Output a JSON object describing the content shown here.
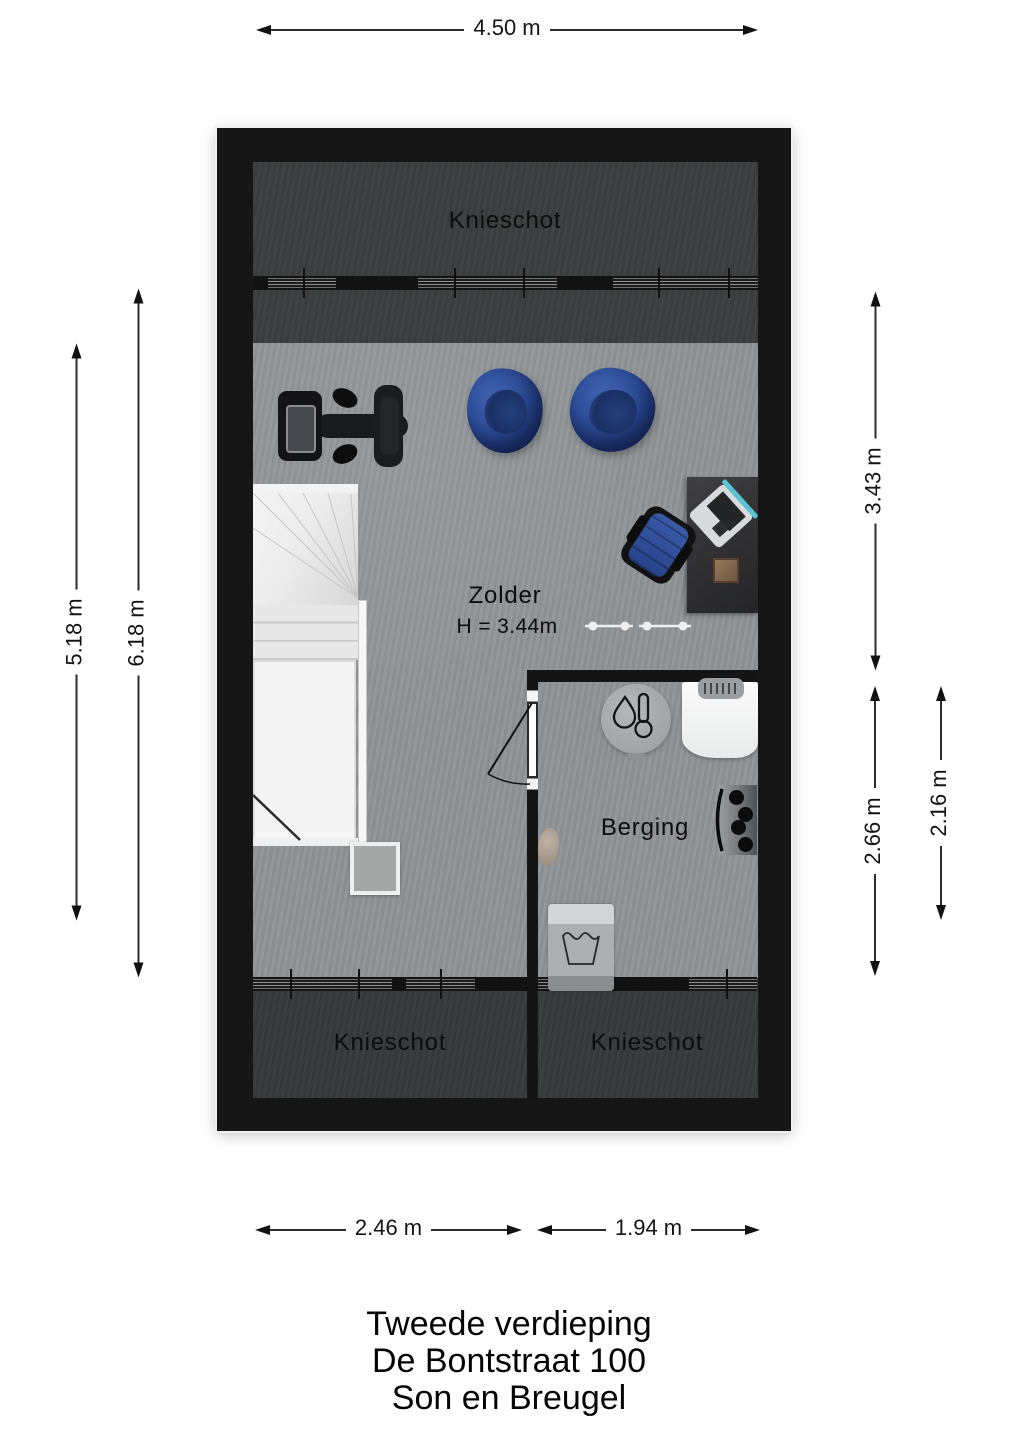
{
  "plan": {
    "rooms": [
      {
        "label": "Knieschot",
        "position": "top"
      },
      {
        "label": "Zolder",
        "height": "H = 3.44m"
      },
      {
        "label": "Berging"
      },
      {
        "label": "Knieschot",
        "position": "bottom-left"
      },
      {
        "label": "Knieschot",
        "position": "bottom-right"
      }
    ],
    "furniture": [
      "exercise-bike",
      "bean-bag",
      "bean-bag",
      "staircase",
      "side-mat",
      "desk",
      "laptop",
      "book",
      "mouse",
      "office-chair",
      "dumbbells",
      "boiler",
      "workbench",
      "control-panel",
      "storage-object",
      "washing-machine",
      "door"
    ]
  },
  "dimensions": {
    "top_width": "4.50 m",
    "left_inner_height": "5.18 m",
    "left_outer_height": "6.18 m",
    "right_upper_height": "3.43 m",
    "right_lower_outer": "2.66 m",
    "right_lower_inner": "2.16 m",
    "bottom_left_width": "2.46 m",
    "bottom_right_width": "1.94 m"
  },
  "title": {
    "line1": "Tweede verdieping",
    "line2": "De Bontstraat 100",
    "line3": "Son en Breugel"
  },
  "colors": {
    "wall": "#161616",
    "floor_light": "#8f9396",
    "floor_dark": "#3b3d3e",
    "beanbag_blue": "#2d4b92",
    "chair_blue": "#2e4e9a",
    "stairs_white": "#f2f2f2",
    "laptop_accent_teal": "#59c3d3",
    "dimension_text": "#141414"
  }
}
